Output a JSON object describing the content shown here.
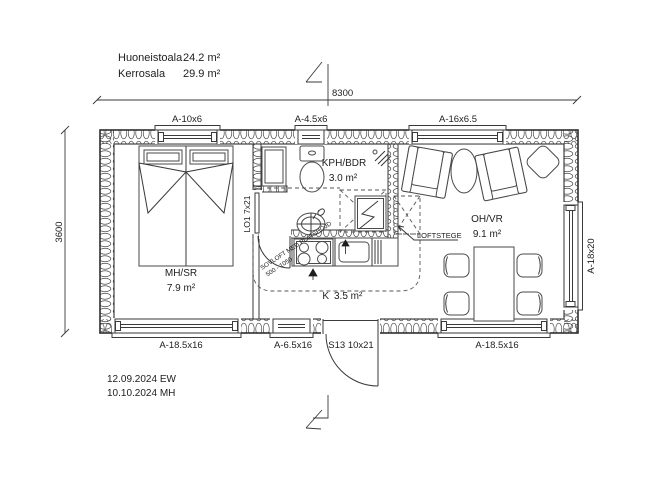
{
  "drawing": {
    "title_block": {
      "areas": [
        {
          "label": "Huoneistoala",
          "value": "24.2 m²"
        },
        {
          "label": "Kerrosala",
          "value": "29.9 m²"
        }
      ],
      "revisions": [
        "12.09.2024 EW",
        "10.10.2024 MH"
      ]
    },
    "dimensions": {
      "overall_width": "8300",
      "overall_height": "3600"
    },
    "rooms": {
      "bedroom": {
        "name": "MH/SR",
        "area": "7.9 m²"
      },
      "bathroom": {
        "name": "KPH/BDR",
        "area": "3.0 m²"
      },
      "living": {
        "name": "OH/VR",
        "area": "9.1 m²"
      },
      "kitchen": {
        "name": "K",
        "area": "3.5 m²"
      }
    },
    "openings": {
      "window_top_left": "A-10x6",
      "window_top_mid": "A-4.5x6",
      "window_top_right": "A-16x6.5",
      "window_bottom_left": "A-18.5x16",
      "window_bottom_mid": "A-6.5x16",
      "entry_door": "S13 10x21",
      "window_bottom_right": "A-18.5x16",
      "window_right": "A-18x20",
      "sliding_door": "LO1 7x21"
    },
    "annotations": {
      "loft_ladder": "LOFTSTEGE",
      "loft_note_1": "SOVLOFT MED PLATSHÖJD",
      "loft_note_2": "500 - 1050"
    },
    "colors": {
      "line": "#3a3a3a",
      "dashed": "#555555",
      "text": "#1e1e1e",
      "background": "#ffffff"
    }
  }
}
